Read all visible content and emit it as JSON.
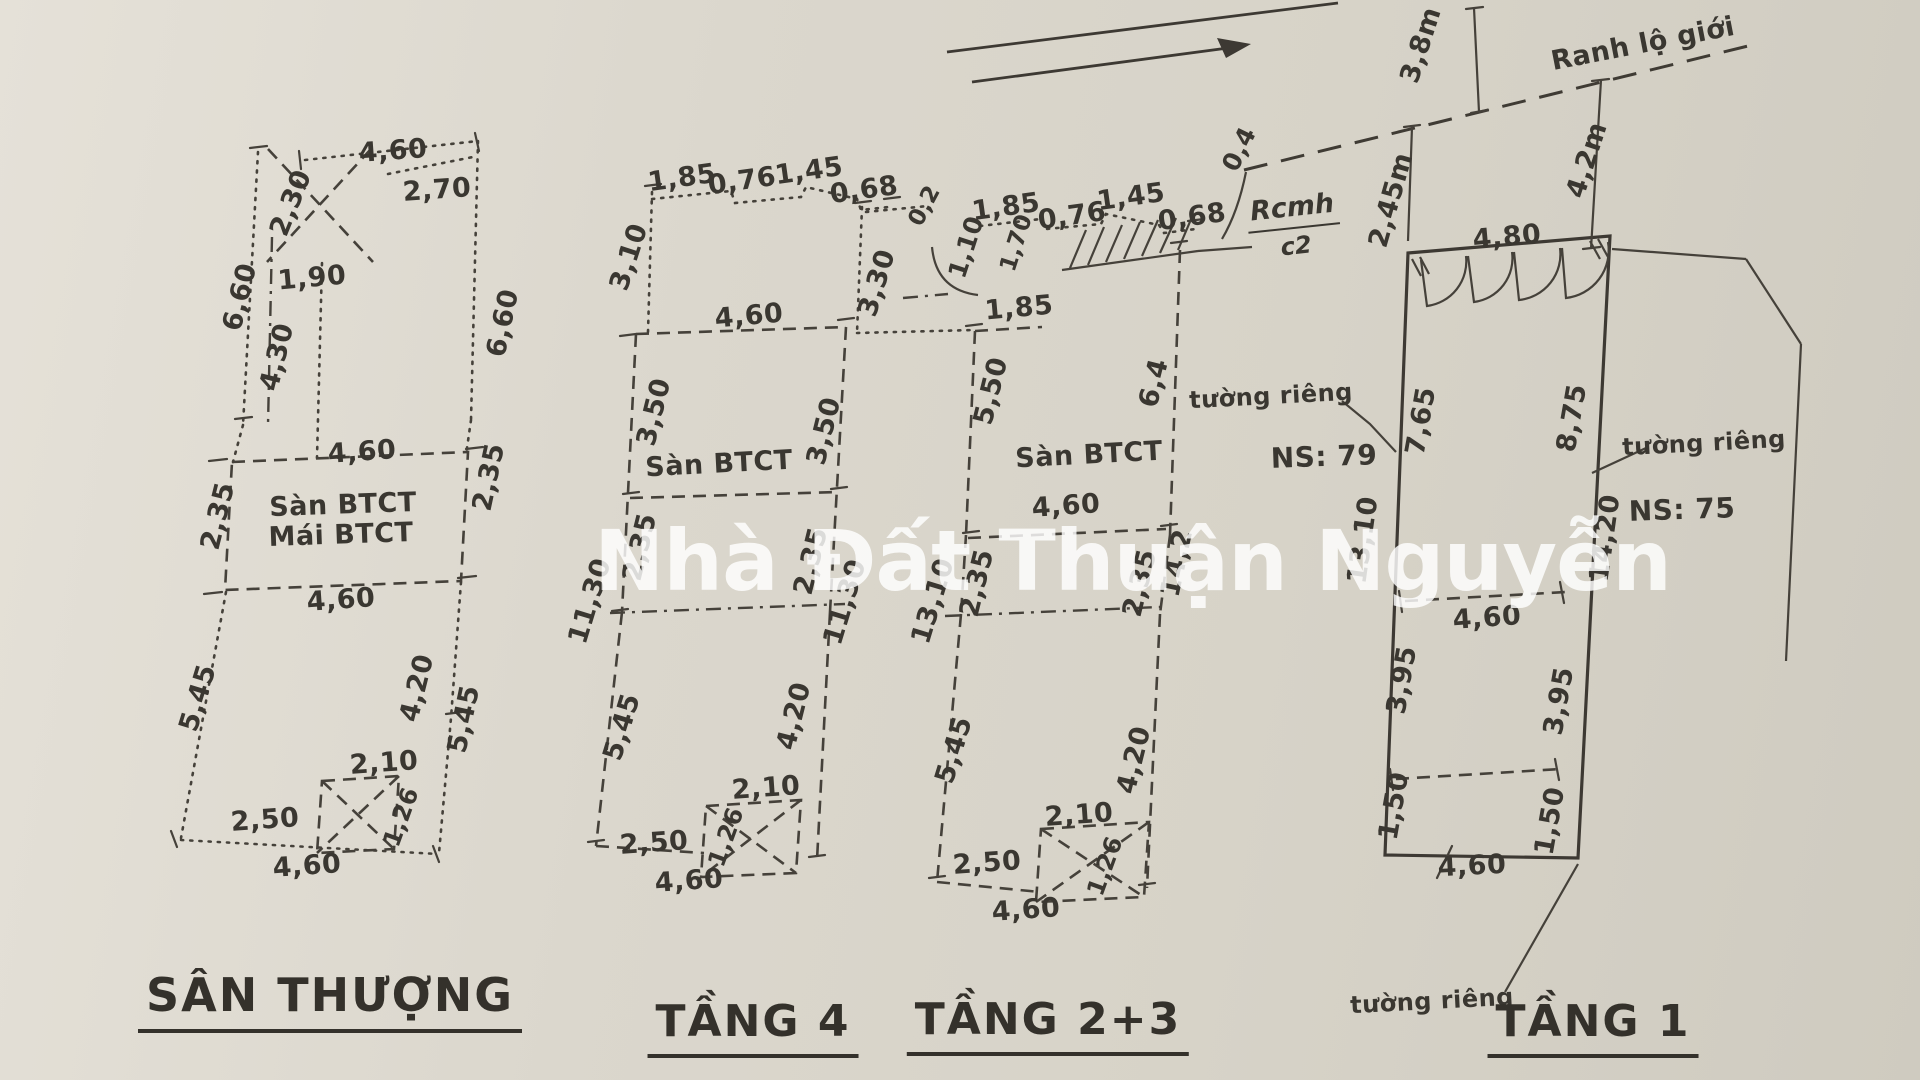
{
  "watermark": "Nhà Đất Thuận Nguyễn",
  "plans": [
    {
      "id": "san-thuong",
      "label": "SÂN THƯỢNG"
    },
    {
      "id": "tang-4",
      "label": "TẦNG 4"
    },
    {
      "id": "tang-2-3",
      "label": "TẦNG 2+3"
    },
    {
      "id": "tang-1",
      "label": "TẦNG 1"
    }
  ],
  "handwritten_note": {
    "top": "Rcmh",
    "bottom": "c2"
  },
  "annotation_labels": [
    [
      "Ranh lộ giới",
      1643,
      44,
      -11,
      27
    ],
    [
      "tường riêng",
      1271,
      396,
      -3,
      24
    ],
    [
      "NS: 79",
      1324,
      457,
      -2,
      28
    ],
    [
      "tường riêng",
      1704,
      443,
      -3,
      24
    ],
    [
      "NS: 75",
      1682,
      510,
      -2,
      28
    ],
    [
      "tường riêng",
      1432,
      1001,
      -3,
      24
    ],
    [
      "Sàn BTCT",
      343,
      505,
      -2,
      27
    ],
    [
      "Mái BTCT",
      341,
      535,
      -2,
      27
    ],
    [
      "Sàn BTCT",
      719,
      464,
      -3,
      27
    ],
    [
      "Sàn BTCT",
      1089,
      455,
      -3,
      27
    ]
  ],
  "dimension_labels": [
    [
      "4,60",
      393,
      151,
      -4
    ],
    [
      "2,70",
      437,
      190,
      -4
    ],
    [
      "2,30",
      291,
      203,
      -68
    ],
    [
      "1,90",
      312,
      278,
      -5
    ],
    [
      "6,60",
      240,
      297,
      -76
    ],
    [
      "4,30",
      277,
      357,
      -76
    ],
    [
      "6,60",
      503,
      323,
      -78
    ],
    [
      "4,60",
      362,
      452,
      -4
    ],
    [
      "2,35",
      218,
      516,
      -76
    ],
    [
      "2,35",
      489,
      477,
      -78
    ],
    [
      "4,60",
      341,
      600,
      -4
    ],
    [
      "5,45",
      198,
      698,
      -73
    ],
    [
      "4,20",
      417,
      688,
      -76
    ],
    [
      "5,45",
      464,
      719,
      -78
    ],
    [
      "2,10",
      384,
      763,
      -4
    ],
    [
      "1,26",
      401,
      817,
      -70,
      24
    ],
    [
      "2,50",
      265,
      820,
      -4
    ],
    [
      "4,60",
      307,
      866,
      -4
    ],
    [
      "1,85",
      682,
      178,
      -8
    ],
    [
      "0,76",
      742,
      181,
      -8
    ],
    [
      "1,45",
      809,
      171,
      -8
    ],
    [
      "0,68",
      864,
      190,
      -8
    ],
    [
      "3,10",
      629,
      257,
      -72
    ],
    [
      "4,60",
      749,
      316,
      -5
    ],
    [
      "3,50",
      654,
      412,
      -76
    ],
    [
      "3,50",
      824,
      431,
      -76
    ],
    [
      "2,35",
      640,
      547,
      -76
    ],
    [
      "2,35",
      811,
      561,
      -76
    ],
    [
      "11,30",
      590,
      601,
      -73
    ],
    [
      "11,30",
      845,
      602,
      -73
    ],
    [
      "5,45",
      622,
      727,
      -73
    ],
    [
      "4,20",
      794,
      716,
      -76
    ],
    [
      "2,10",
      766,
      788,
      -4
    ],
    [
      "1,26",
      726,
      837,
      -70,
      24
    ],
    [
      "2,50",
      654,
      843,
      -4
    ],
    [
      "4,60",
      689,
      881,
      -4
    ],
    [
      "0,2",
      925,
      206,
      -62,
      23
    ],
    [
      "1,10",
      966,
      247,
      -72,
      25
    ],
    [
      "1,70",
      1017,
      243,
      -72,
      23
    ],
    [
      "1,85",
      1006,
      207,
      -8
    ],
    [
      "0,76",
      1072,
      216,
      -8
    ],
    [
      "1,45",
      1131,
      197,
      -8
    ],
    [
      "0,68",
      1192,
      217,
      -8
    ],
    [
      "0,4",
      1239,
      149,
      -64,
      25
    ],
    [
      "3,30",
      877,
      283,
      -73
    ],
    [
      "1,85",
      1019,
      308,
      -5
    ],
    [
      "5,50",
      991,
      391,
      -76
    ],
    [
      "6,4",
      1154,
      383,
      -76
    ],
    [
      "4,60",
      1066,
      506,
      -4
    ],
    [
      "2,35",
      977,
      583,
      -76
    ],
    [
      "2,35",
      1140,
      583,
      -76
    ],
    [
      "14,2",
      1177,
      563,
      -78
    ],
    [
      "13,10",
      933,
      601,
      -73
    ],
    [
      "5,45",
      954,
      750,
      -73
    ],
    [
      "4,20",
      1134,
      760,
      -76
    ],
    [
      "2,10",
      1079,
      815,
      -4
    ],
    [
      "1,26",
      1105,
      866,
      -70,
      24
    ],
    [
      "2,50",
      987,
      863,
      -4
    ],
    [
      "4,60",
      1026,
      910,
      -4
    ],
    [
      "3,8m",
      1421,
      45,
      -72
    ],
    [
      "4,2m",
      1587,
      160,
      -72
    ],
    [
      "2,45m",
      1391,
      200,
      -74
    ],
    [
      "4,80",
      1507,
      237,
      -5
    ],
    [
      "7,65",
      1421,
      421,
      -80
    ],
    [
      "8,75",
      1572,
      418,
      -80
    ],
    [
      "13,10",
      1363,
      540,
      -82
    ],
    [
      "14,20",
      1605,
      538,
      -82
    ],
    [
      "4,60",
      1487,
      618,
      -4
    ],
    [
      "3,95",
      1402,
      680,
      -80
    ],
    [
      "3,95",
      1559,
      701,
      -80
    ],
    [
      "1,50",
      1394,
      806,
      -80
    ],
    [
      "1,50",
      1550,
      821,
      -80
    ],
    [
      "4,60",
      1472,
      866,
      -3
    ]
  ]
}
